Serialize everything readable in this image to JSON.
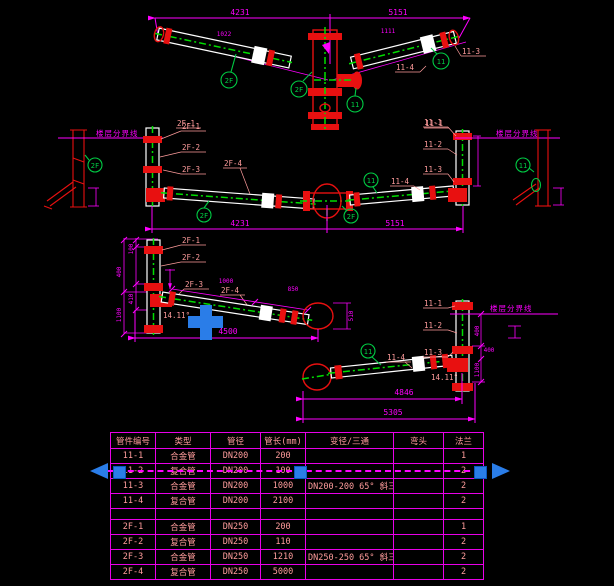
{
  "colors": {
    "background": "#000000",
    "dimension": "#ff00ff",
    "label": "#ff9c9c",
    "pipe_outline": "#ffffff",
    "pipe_centerline": "#00dd00",
    "fitting_red": "#e81010",
    "balloon_green": "#00cc44",
    "selection_blue": "#2a7de8",
    "table_grid": "#e800e8"
  },
  "top_view": {
    "dim_total_left": "4231",
    "dim_total_right": "5151",
    "dim_sub_left": "1022",
    "dim_sub_right": "1111",
    "balloon_left_arm": "2F",
    "balloon_column": "2F",
    "balloon_tee": "11",
    "balloon_right_arm": "11",
    "label_left_arm": "2F-1",
    "label_right_arm": "11-1",
    "label_right_mid": "11-4",
    "label_right_end": "11-3"
  },
  "elevation": {
    "floor_label_left": "楼层分界线",
    "floor_label_right": "楼层分界线",
    "left_support_balloon": "2F",
    "right_support_balloon": "11",
    "left_pipe_labels": [
      "2F-1",
      "2F-2",
      "2F-3"
    ],
    "right_pipe_labels": [
      "11-1",
      "11-2",
      "11-3"
    ],
    "run_label_left": "2F-4",
    "run_balloon_left": "2F",
    "junction_balloon": "2F",
    "run_balloon_right": "11",
    "run_label_right": "11-4",
    "dim_left": "4231",
    "dim_right": "5151"
  },
  "detail_2f": {
    "pipe_labels": [
      "2F-1",
      "2F-2",
      "2F-3",
      "2F-4"
    ],
    "angle": "14.11°",
    "dim_seg1": "1000",
    "dim_seg2": "850",
    "dim_total": "4500",
    "dim_end": "510",
    "left_dims": [
      "100",
      "410",
      "400",
      "1100"
    ]
  },
  "detail_11": {
    "pipe_labels": [
      "11-1",
      "11-2",
      "11-3",
      "11-4"
    ],
    "balloon": "11",
    "angle": "14.11°",
    "floor_label": "楼层分界线",
    "dim_run": "4846",
    "dim_total": "5305",
    "right_dims": [
      "400",
      "1100",
      "400"
    ]
  },
  "table": {
    "headers": [
      "管件编号",
      "类型",
      "管径",
      "管长(mm)",
      "变径/三通",
      "弯头",
      "法兰"
    ],
    "rows": [
      {
        "c": [
          "11-1",
          "合金管",
          "DN200",
          "200",
          "",
          "",
          "1"
        ]
      },
      {
        "c": [
          "11-2",
          "复合管",
          "DN200",
          "100",
          "",
          "",
          "2"
        ]
      },
      {
        "c": [
          "11-3",
          "合金管",
          "DN200",
          "1000",
          "DN200-200 65° 斜三通",
          "",
          "2"
        ]
      },
      {
        "c": [
          "11-4",
          "复合管",
          "DN200",
          "2100",
          "",
          "",
          "2"
        ]
      },
      {
        "c": [
          "",
          "",
          "",
          "",
          "",
          "",
          ""
        ]
      },
      {
        "c": [
          "2F-1",
          "合金管",
          "DN250",
          "200",
          "",
          "",
          "1"
        ]
      },
      {
        "c": [
          "2F-2",
          "复合管",
          "DN250",
          "110",
          "",
          "",
          "2"
        ]
      },
      {
        "c": [
          "2F-3",
          "合金管",
          "DN250",
          "1210",
          "DN250-250 65° 斜三通",
          "",
          "2"
        ]
      },
      {
        "c": [
          "2F-4",
          "复合管",
          "DN250",
          "5000",
          "",
          "",
          "2"
        ]
      }
    ]
  }
}
